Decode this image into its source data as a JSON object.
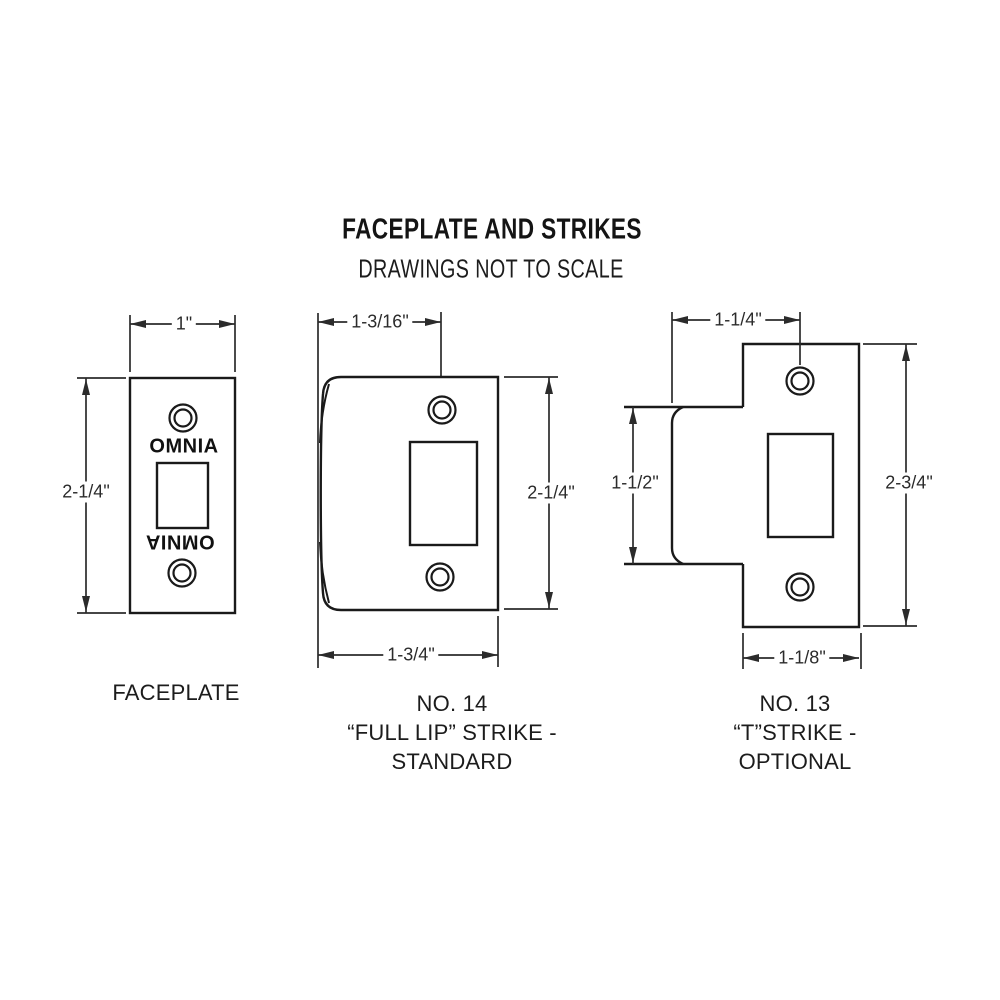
{
  "title": "FACEPLATE AND STRIKES",
  "subtitle": "DRAWINGS NOT TO SCALE",
  "drawings": {
    "faceplate": {
      "label": "FACEPLATE",
      "width_dim": "1\"",
      "height_dim": "2-1/4\"",
      "engraving_top": "OMNIA",
      "engraving_bottom": "OMNIA"
    },
    "full_lip_strike": {
      "label_lines": [
        "NO. 14",
        "“FULL LIP” STRIKE -",
        "STANDARD"
      ],
      "hole_offset_dim": "1-3/16\"",
      "height_dim": "2-1/4\"",
      "width_dim": "1-3/4\""
    },
    "t_strike": {
      "label_lines": [
        "NO. 13",
        "“T”STRIKE -",
        "OPTIONAL"
      ],
      "hole_offset_dim": "1-1/4\"",
      "lip_height_dim": "1-1/2\"",
      "height_dim": "2-3/4\"",
      "width_dim": "1-1/8\""
    }
  }
}
